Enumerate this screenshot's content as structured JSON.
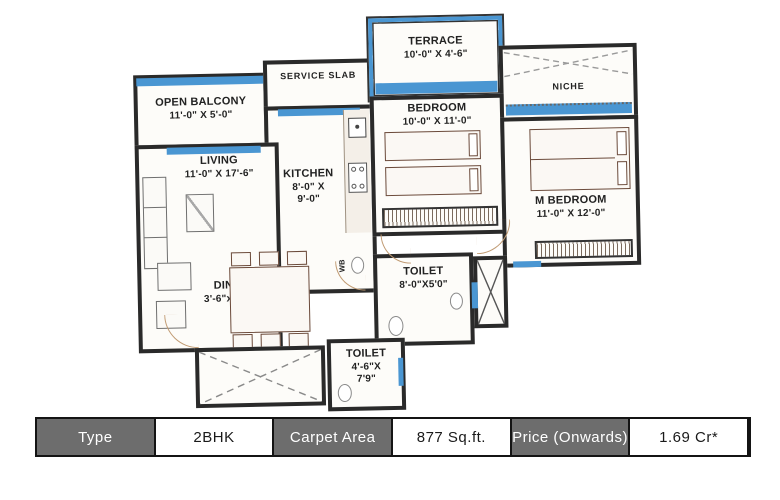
{
  "plan": {
    "labels": {
      "open_balcony_name": "OPEN BALCONY",
      "open_balcony_dims": "11'-0\" X 5'-0\"",
      "service_slab_name": "SERVICE SLAB",
      "terrace_name": "TERRACE",
      "terrace_dims": "10'-0\" X 4'-6\"",
      "bedroom_name": "BEDROOM",
      "bedroom_dims": "10'-0\" X 11'-0\"",
      "niche_name": "NICHE",
      "living_name": "LIVING",
      "living_dims": "11'-0\" X 17'-6\"",
      "kitchen_name": "KITCHEN",
      "kitchen_dims1": "8'-0\" X",
      "kitchen_dims2": "9'-0\"",
      "m_bedroom_name": "M BEDROOM",
      "m_bedroom_dims": "11'-0\" X 12'-0\"",
      "dining_name": "DINING",
      "dining_dims": "3'-6\"x 10'-2\"",
      "toilet1_name": "TOILET",
      "toilet1_dims": "8'-0\"X5'0\"",
      "toilet2_name": "TOILET",
      "toilet2_dims1": "4'-6\"X",
      "toilet2_dims2": "7'9\"",
      "wb_label": "WB"
    },
    "colors": {
      "wall": "#2a2a2a",
      "window_blue": "#4a96d2",
      "furniture": "#6b4a3a"
    }
  },
  "info_table": {
    "header_bg": "#6d6d6d",
    "value_bg": "#ffffff",
    "cells": [
      {
        "label": "Type"
      },
      {
        "label": "2BHK"
      },
      {
        "label": "Carpet Area"
      },
      {
        "label": "877 Sq.ft."
      },
      {
        "label": "Price (Onwards)"
      },
      {
        "label": "1.69 Cr*"
      }
    ]
  }
}
